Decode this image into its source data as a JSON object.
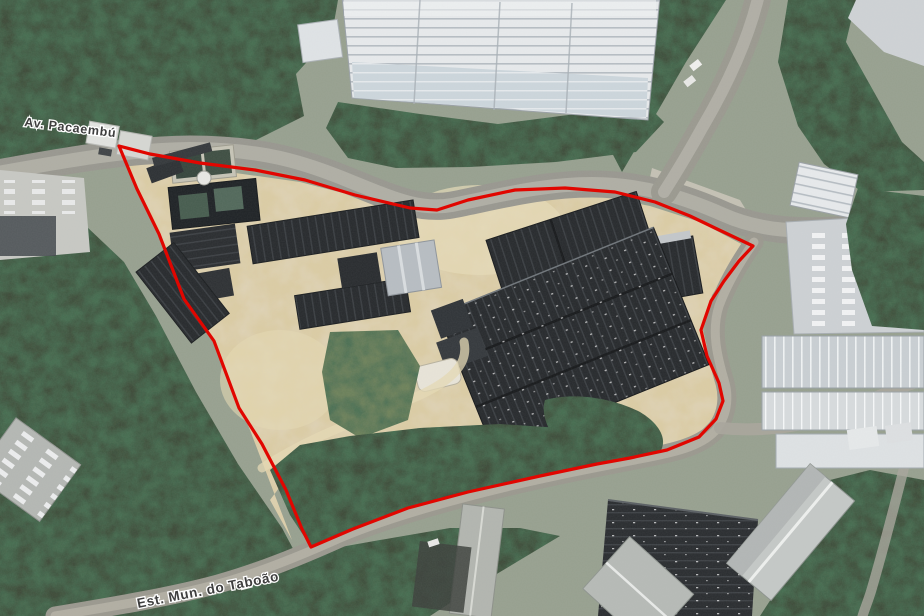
{
  "map": {
    "view": "satellite",
    "road_labels": {
      "top_road": "Av. Pacaembú",
      "bottom_road": "Est. Mun. do Taboão"
    },
    "boundary": {
      "color": "#e10600",
      "stroke_width": "3.2",
      "points": "119,146 150,154 200,163 255,170 305,180 355,195 410,208 437,210 468,200 515,190 565,188 615,192 655,202 690,216 715,228 753,246 739,261 724,281 711,301 701,330 707,356 719,383 723,401 716,419 699,437 667,450 630,458 597,464 540,476 468,492 408,508 353,529 311,547 302,529 286,490 262,444 239,408 214,341 184,299 159,234 137,189"
    }
  }
}
